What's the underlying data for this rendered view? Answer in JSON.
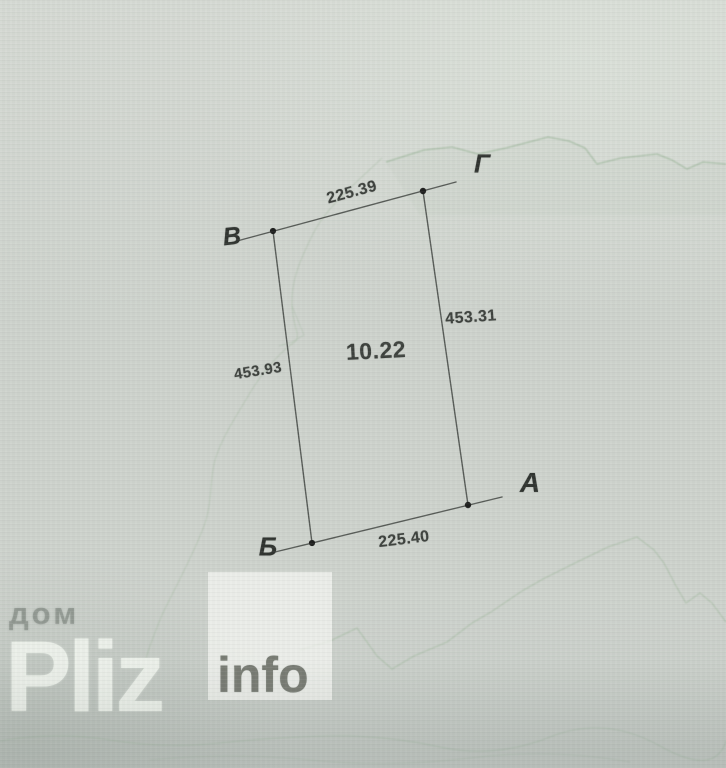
{
  "plan": {
    "points": [
      {
        "label": "В"
      },
      {
        "label": "Г"
      },
      {
        "label": "А"
      },
      {
        "label": "Б"
      }
    ],
    "measurements": {
      "side_vg": "225.39",
      "side_ga": "453.31",
      "side_vb": "453.93",
      "side_ba": "225.40",
      "area": "10.22"
    }
  },
  "watermark": {
    "site_prefix": "дом",
    "site_name": "Pliz",
    "site_suffix": "info"
  },
  "colors": {
    "paper": "#ced3cd",
    "paper-light": "#d6dad4",
    "paper-dark": "#c4cac5",
    "ink": "#3c403c",
    "line": "#565a56",
    "dot": "#1d1e1d",
    "contour": "#9db69a"
  }
}
